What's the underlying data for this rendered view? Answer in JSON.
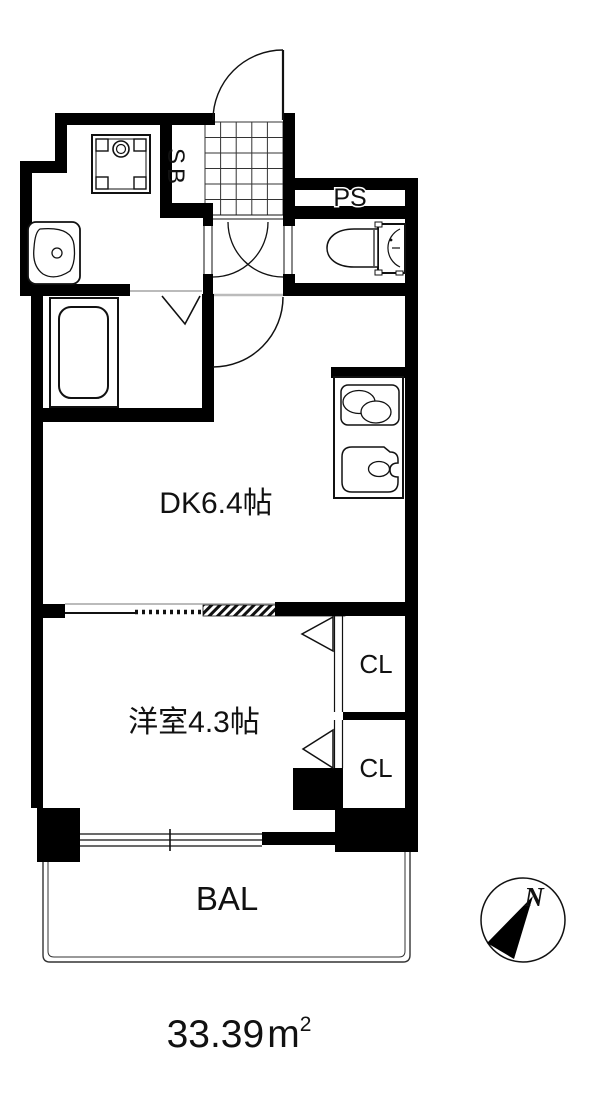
{
  "floorplan": {
    "title": "apartment-floor-plan",
    "labels": {
      "shoe_box": "SB",
      "pipe_space": "PS",
      "dining_kitchen": "DK6.4帖",
      "western_room": "洋室4.3帖",
      "closet_upper": "CL",
      "closet_lower": "CL",
      "balcony": "BAL",
      "compass_north": "N",
      "area_value": "33.39",
      "area_unit": "m",
      "area_sup": "2"
    },
    "fixtures": [
      "entrance-door",
      "entrance-tile-floor",
      "washing-machine-pan",
      "wash-basin",
      "bathtub",
      "folding-bath-door",
      "toilet",
      "kitchen-stove",
      "kitchen-sink",
      "sliding-partition",
      "closet-folding-door",
      "balcony-window",
      "compass"
    ],
    "colors": {
      "wall": "#000000",
      "background": "#ffffff",
      "line": "#111111",
      "threshold": "#bbbbbb"
    }
  }
}
